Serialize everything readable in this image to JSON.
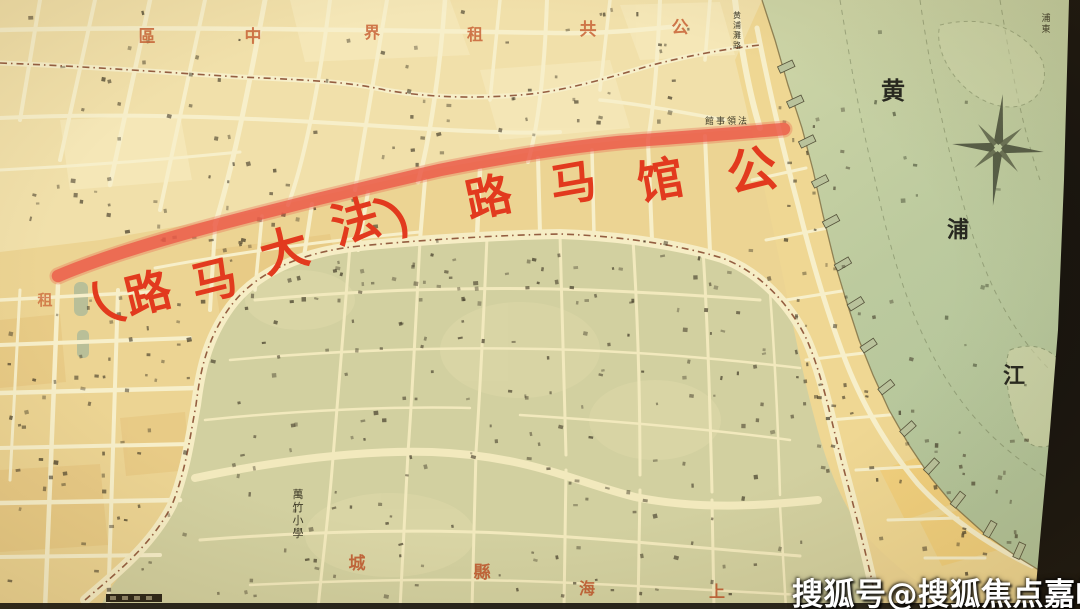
{
  "image_type": "historical-map-photo",
  "map": {
    "red_route_annotation": {
      "reading": "公馆马路（法大马路）",
      "color": "#e23a1e",
      "chars": [
        {
          "ch": "（",
          "x": 106,
          "y": 330,
          "rot": -40,
          "size": 52
        },
        {
          "ch": "路",
          "x": 152,
          "y": 309,
          "rot": -14,
          "size": 46
        },
        {
          "ch": "马",
          "x": 218,
          "y": 296,
          "rot": -14,
          "size": 46
        },
        {
          "ch": "大",
          "x": 289,
          "y": 267,
          "rot": -16,
          "size": 48
        },
        {
          "ch": "法",
          "x": 360,
          "y": 238,
          "rot": -16,
          "size": 48
        },
        {
          "ch": "）",
          "x": 419,
          "y": 220,
          "rot": -40,
          "size": 52
        },
        {
          "ch": "路",
          "x": 492,
          "y": 213,
          "rot": -12,
          "size": 46
        },
        {
          "ch": "马",
          "x": 576,
          "y": 199,
          "rot": -10,
          "size": 46
        },
        {
          "ch": "馆",
          "x": 663,
          "y": 196,
          "rot": -10,
          "size": 46
        },
        {
          "ch": "公",
          "x": 755,
          "y": 188,
          "rot": -10,
          "size": 50
        }
      ]
    },
    "district_label": {
      "reading": "公共租界中區",
      "color": "#c96336",
      "chars": [
        {
          "ch": "區",
          "x": 147,
          "y": 42,
          "size": 17
        },
        {
          "ch": "中",
          "x": 253,
          "y": 42,
          "size": 17
        },
        {
          "ch": "界",
          "x": 372,
          "y": 38,
          "size": 16
        },
        {
          "ch": "租",
          "x": 475,
          "y": 40,
          "size": 16
        },
        {
          "ch": "共",
          "x": 588,
          "y": 35,
          "size": 17
        },
        {
          "ch": "公",
          "x": 680,
          "y": 33,
          "size": 17
        }
      ]
    },
    "concession_label": {
      "reading": "租",
      "color": "#cc6a3a",
      "chars": [
        {
          "ch": "租",
          "x": 45,
          "y": 305,
          "size": 15
        }
      ]
    },
    "old_city_label": {
      "reading": "上海縣城",
      "color": "#bf5a30",
      "chars": [
        {
          "ch": "城",
          "x": 357,
          "y": 569,
          "size": 17
        },
        {
          "ch": "縣",
          "x": 482,
          "y": 578,
          "size": 17
        },
        {
          "ch": "海",
          "x": 587,
          "y": 594,
          "size": 16
        },
        {
          "ch": "上",
          "x": 717,
          "y": 597,
          "size": 16
        }
      ]
    },
    "river_label": {
      "reading": "黄浦江",
      "color": "#272820",
      "chars": [
        {
          "ch": "黄",
          "x": 893,
          "y": 99,
          "size": 24
        },
        {
          "ch": "浦",
          "x": 958,
          "y": 237,
          "size": 22
        },
        {
          "ch": "江",
          "x": 1014,
          "y": 383,
          "size": 22
        }
      ]
    },
    "street_labels": [
      {
        "text": "黄浦灘路",
        "x": 737,
        "y": 10,
        "vertical": true,
        "size": 8
      },
      {
        "text": "館事領法",
        "x": 726,
        "y": 124,
        "vertical": false,
        "size": 9,
        "note": "read right-to-left: 法領事館"
      },
      {
        "text": "萬竹小學",
        "x": 298,
        "y": 487,
        "vertical": true,
        "size": 11
      },
      {
        "text": "浦東",
        "x": 1046,
        "y": 12,
        "vertical": true,
        "size": 9
      }
    ],
    "palette": {
      "paper": "#f1e0aa",
      "concession": "#ecd493",
      "old_city": "#d2d0a0",
      "waterfront": "#efd793",
      "water_near": "#ccd4a6",
      "water_far": "#b2c49a",
      "street": "#f7efca",
      "route_red": "#ec5a48",
      "boundary_dash": "#7c3a1f",
      "dark_edge": "#15120e"
    }
  },
  "watermark": {
    "text": "搜狐号@搜狐焦点嘉峪关站",
    "color": "#ffffff"
  }
}
